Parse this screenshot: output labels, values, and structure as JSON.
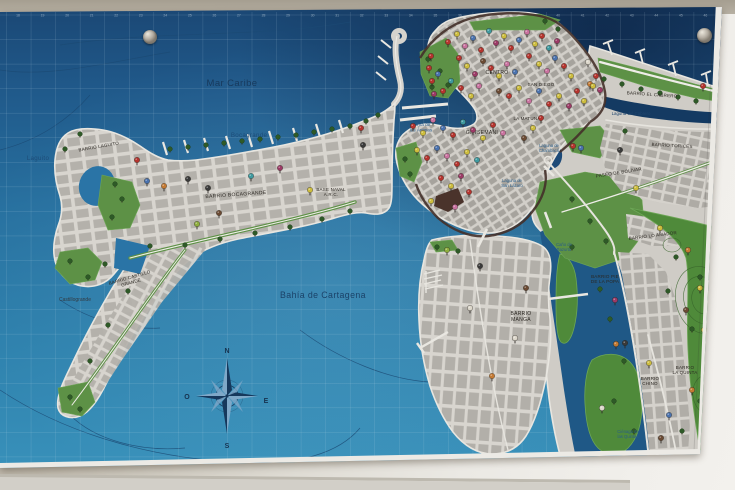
{
  "labels": {
    "mar_caribe": "Mar Caribe",
    "bocagrande_sea": "Bocagrande",
    "laguito": "Laguito",
    "bahia_cartagena": "Bahía de Cartagena",
    "bahia_animas": "Bahía de\nlas Ánimas",
    "laguna_cabrero": "Laguna del Cabrero",
    "laguna_chambacu": "Laguna de\nChambacú",
    "laguna_san_lazaro": "Laguna de\nSan Lázaro",
    "cano_bazurto": "Caño de\nBazurto",
    "cienaga_quintas": "Ciénaga de\nlas Quintas",
    "barrio_laguito": "BARRIO LAGUITO",
    "barrio_bocagrande": "BARRIO BOCAGRANDE",
    "base_naval": "BASE NAVAL\nA.R.C.",
    "barrio_castillo_grande": "BARRIO CASTILLO\nGRANDE",
    "castillogrande": "Castillogrande",
    "centro": "CENTRO",
    "san_diego": "SAN DIEGO",
    "la_matuna": "LA MATUNA",
    "getsemani": "GETSEMANI",
    "barrio_el_cabrero": "BARRIO EL CABRERO",
    "barrio_torices": "BARRIO TORICES",
    "paseo_bolivar": "PASEO DE BOLÍVAR",
    "barrio_lo_amador": "BARRIO LO AMADOR",
    "barrio_manga": "BARRIO\nMANGA",
    "barrio_pie_popa": "BARRIO PIE\nDE LA POPA",
    "barrio_chino": "BARRIO\nCHINO",
    "barrio_la_quinta": "BARRIO\nLA QUINTA"
  },
  "compass": {
    "n": "N",
    "s": "S",
    "e": "E",
    "o": "O"
  },
  "map": {
    "grid_numbers": [
      "18",
      "19",
      "20",
      "21",
      "22",
      "23",
      "24",
      "25",
      "26",
      "27",
      "28",
      "29",
      "30",
      "31",
      "32",
      "33",
      "34",
      "35",
      "36",
      "37",
      "38",
      "39",
      "40",
      "41",
      "42",
      "43",
      "44",
      "45",
      "46"
    ],
    "pin_colors": {
      "r": "#b5342e",
      "y": "#cdbd3e",
      "p": "#c9729f",
      "m": "#9c3a66",
      "b": "#4a72ae",
      "t": "#3e9aa0",
      "o": "#c47a33",
      "d": "#6b4a33",
      "k": "#3a3a3a",
      "w": "#ddd8cc",
      "g": "#8fae3e"
    },
    "pins": [
      [
        448,
        44,
        "r"
      ],
      [
        457,
        36,
        "y"
      ],
      [
        465,
        48,
        "p"
      ],
      [
        473,
        40,
        "b"
      ],
      [
        481,
        52,
        "r"
      ],
      [
        489,
        33,
        "t"
      ],
      [
        496,
        45,
        "m"
      ],
      [
        504,
        38,
        "y"
      ],
      [
        511,
        50,
        "r"
      ],
      [
        519,
        42,
        "b"
      ],
      [
        527,
        34,
        "p"
      ],
      [
        535,
        46,
        "y"
      ],
      [
        542,
        38,
        "r"
      ],
      [
        549,
        50,
        "t"
      ],
      [
        557,
        43,
        "m"
      ],
      [
        529,
        58,
        "r"
      ],
      [
        539,
        66,
        "y"
      ],
      [
        547,
        73,
        "p"
      ],
      [
        555,
        60,
        "b"
      ],
      [
        564,
        68,
        "r"
      ],
      [
        571,
        78,
        "y"
      ],
      [
        483,
        63,
        "d"
      ],
      [
        491,
        70,
        "r"
      ],
      [
        499,
        78,
        "y"
      ],
      [
        507,
        66,
        "p"
      ],
      [
        515,
        74,
        "b"
      ],
      [
        459,
        60,
        "r"
      ],
      [
        467,
        68,
        "y"
      ],
      [
        475,
        76,
        "m"
      ],
      [
        451,
        83,
        "t"
      ],
      [
        461,
        90,
        "r"
      ],
      [
        471,
        98,
        "y"
      ],
      [
        479,
        88,
        "p"
      ],
      [
        438,
        76,
        "b"
      ],
      [
        443,
        93,
        "r"
      ],
      [
        499,
        93,
        "d"
      ],
      [
        509,
        98,
        "r"
      ],
      [
        519,
        90,
        "y"
      ],
      [
        529,
        103,
        "p"
      ],
      [
        539,
        93,
        "b"
      ],
      [
        549,
        106,
        "r"
      ],
      [
        559,
        98,
        "y"
      ],
      [
        569,
        108,
        "m"
      ],
      [
        577,
        93,
        "r"
      ],
      [
        584,
        103,
        "y"
      ],
      [
        590,
        86,
        "o"
      ],
      [
        596,
        78,
        "r"
      ],
      [
        588,
        64,
        "w"
      ],
      [
        431,
        58,
        "r"
      ],
      [
        429,
        70,
        "r"
      ],
      [
        432,
        83,
        "r"
      ],
      [
        434,
        96,
        "m"
      ],
      [
        413,
        128,
        "r"
      ],
      [
        423,
        135,
        "y"
      ],
      [
        433,
        122,
        "p"
      ],
      [
        443,
        130,
        "b"
      ],
      [
        453,
        137,
        "r"
      ],
      [
        463,
        124,
        "t"
      ],
      [
        473,
        132,
        "m"
      ],
      [
        483,
        140,
        "y"
      ],
      [
        493,
        127,
        "r"
      ],
      [
        503,
        135,
        "p"
      ],
      [
        417,
        152,
        "y"
      ],
      [
        427,
        160,
        "r"
      ],
      [
        437,
        150,
        "b"
      ],
      [
        447,
        158,
        "p"
      ],
      [
        457,
        166,
        "r"
      ],
      [
        467,
        154,
        "y"
      ],
      [
        477,
        162,
        "t"
      ],
      [
        441,
        180,
        "r"
      ],
      [
        451,
        188,
        "y"
      ],
      [
        461,
        178,
        "m"
      ],
      [
        469,
        194,
        "r"
      ],
      [
        431,
        203,
        "y"
      ],
      [
        455,
        209,
        "p"
      ],
      [
        541,
        120,
        "r"
      ],
      [
        533,
        130,
        "y"
      ],
      [
        524,
        140,
        "d"
      ],
      [
        137,
        162,
        "r"
      ],
      [
        147,
        183,
        "b"
      ],
      [
        164,
        188,
        "o"
      ],
      [
        188,
        181,
        "k"
      ],
      [
        208,
        190,
        "k"
      ],
      [
        197,
        226,
        "g"
      ],
      [
        219,
        215,
        "d"
      ],
      [
        310,
        192,
        "y"
      ],
      [
        361,
        130,
        "r"
      ],
      [
        363,
        147,
        "k"
      ],
      [
        251,
        178,
        "t"
      ],
      [
        280,
        170,
        "m"
      ],
      [
        447,
        252,
        "g"
      ],
      [
        480,
        268,
        "k"
      ],
      [
        526,
        290,
        "d"
      ],
      [
        492,
        378,
        "o"
      ],
      [
        470,
        310,
        "w"
      ],
      [
        515,
        340,
        "w"
      ],
      [
        593,
        88,
        "y"
      ],
      [
        600,
        92,
        "m"
      ],
      [
        703,
        88,
        "r"
      ],
      [
        573,
        148,
        "r"
      ],
      [
        581,
        150,
        "b"
      ],
      [
        620,
        152,
        "k"
      ],
      [
        636,
        190,
        "y"
      ],
      [
        615,
        302,
        "m"
      ],
      [
        616,
        346,
        "o"
      ],
      [
        625,
        345,
        "k"
      ],
      [
        669,
        417,
        "b"
      ],
      [
        660,
        230,
        "y"
      ],
      [
        688,
        252,
        "o"
      ],
      [
        700,
        290,
        "y"
      ],
      [
        686,
        312,
        "d"
      ],
      [
        704,
        332,
        "y"
      ],
      [
        649,
        365,
        "y"
      ],
      [
        692,
        392,
        "o"
      ],
      [
        661,
        440,
        "d"
      ],
      [
        602,
        410,
        "w"
      ]
    ],
    "trees": [
      [
        170,
        150
      ],
      [
        188,
        148
      ],
      [
        206,
        146
      ],
      [
        224,
        144
      ],
      [
        242,
        142
      ],
      [
        260,
        140
      ],
      [
        278,
        138
      ],
      [
        296,
        136
      ],
      [
        314,
        133
      ],
      [
        332,
        130
      ],
      [
        350,
        127
      ],
      [
        366,
        122
      ],
      [
        378,
        116
      ],
      [
        150,
        247
      ],
      [
        185,
        246
      ],
      [
        220,
        240
      ],
      [
        255,
        234
      ],
      [
        290,
        228
      ],
      [
        322,
        220
      ],
      [
        350,
        212
      ],
      [
        80,
        135
      ],
      [
        65,
        150
      ],
      [
        115,
        185
      ],
      [
        122,
        200
      ],
      [
        112,
        218
      ],
      [
        70,
        262
      ],
      [
        88,
        278
      ],
      [
        105,
        265
      ],
      [
        128,
        292
      ],
      [
        108,
        326
      ],
      [
        90,
        362
      ],
      [
        70,
        398
      ],
      [
        80,
        410
      ],
      [
        428,
        60
      ],
      [
        440,
        72
      ],
      [
        448,
        86
      ],
      [
        432,
        88
      ],
      [
        545,
        22
      ],
      [
        558,
        30
      ],
      [
        405,
        160
      ],
      [
        410,
        175
      ],
      [
        604,
        80
      ],
      [
        622,
        85
      ],
      [
        641,
        90
      ],
      [
        660,
        94
      ],
      [
        678,
        98
      ],
      [
        696,
        102
      ],
      [
        572,
        200
      ],
      [
        590,
        222
      ],
      [
        606,
        242
      ],
      [
        572,
        248
      ],
      [
        676,
        258
      ],
      [
        700,
        278
      ],
      [
        716,
        300
      ],
      [
        692,
        330
      ],
      [
        712,
        360
      ],
      [
        700,
        402
      ],
      [
        682,
        432
      ],
      [
        718,
        426
      ],
      [
        668,
        292
      ],
      [
        722,
        244
      ],
      [
        610,
        320
      ],
      [
        624,
        362
      ],
      [
        614,
        402
      ],
      [
        634,
        432
      ],
      [
        600,
        290
      ],
      [
        437,
        248
      ],
      [
        458,
        252
      ],
      [
        625,
        132
      ]
    ]
  },
  "colors": {
    "sea_deep": "#1a4673",
    "sea_mid": "#27709f",
    "sea_bright": "#3a93bc",
    "lagoon_dark": "#143a62",
    "land_street": "#d8d5cf",
    "land_block": "#b2afa9",
    "park_green": "#5d9146",
    "hill_green": "#4f8a3a",
    "old_wall_brown": "#44302a",
    "label_navy": "#17395c",
    "label_dark": "#2b2722",
    "wall_tan": "#b7b0a3",
    "wall_light": "#f1efeb"
  }
}
